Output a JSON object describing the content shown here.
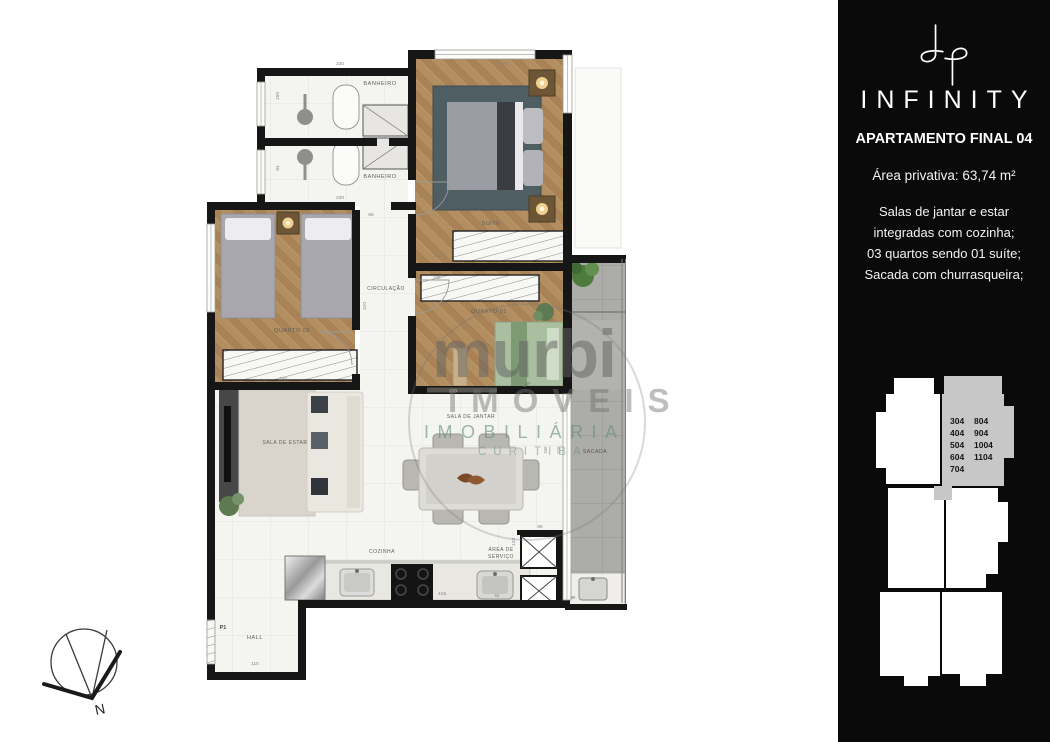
{
  "sidebar": {
    "brand": "INFINITY",
    "apartment_title": "APARTAMENTO FINAL 04",
    "private_area": "Área privativa: 63,74 m²",
    "description_lines": [
      "Salas de jantar e estar",
      "integradas com cozinha;",
      "03 quartos sendo 01 suíte;",
      "Sacada com churrasqueira;"
    ],
    "keyplan_units": {
      "col1": [
        "304",
        "404",
        "504",
        "604",
        "704"
      ],
      "col2": [
        "804",
        "904",
        "1004",
        "1104"
      ]
    }
  },
  "watermark": {
    "brand": "murbi",
    "line2": "IMÓVEIS",
    "line3": "IMOBILIÁRIA",
    "line4": "CURITIBA"
  },
  "plan": {
    "rooms": {
      "banheiro": "BANHEIRO",
      "suite": "SUÍTE",
      "quarto2": "QUARTO 02",
      "quarto1": "QUARTO 01",
      "circulacao": "CIRCULAÇÃO",
      "sacada": "SACADA",
      "sala_estar": "SALA DE ESTAR",
      "sala_jantar": "SALA DE JANTAR",
      "cozinha": "COZINHA",
      "area_servico_l1": "ÁREA DE",
      "area_servico_l2": "SERVIÇO",
      "hall": "HALL"
    },
    "dims": {
      "bath_top_width": "230",
      "bath1_height": "150",
      "bath2_height": "84",
      "bath_bottom_width": "230",
      "suite_width": "240",
      "suite_entry": "90",
      "circ_top": "65",
      "circ_height": "310",
      "suite_closet": "240",
      "q1_closet": "240",
      "q2_width": "245",
      "q1_width": "270",
      "kitchen_run": "415",
      "tank_width": "84",
      "service_depth": "120",
      "shaft_width": "85",
      "churras_width": "90",
      "hall_width": "110",
      "sacada_door_a": "240",
      "sacada_door_b": "510"
    },
    "door_tag": "P1",
    "compass_north": "N"
  },
  "colors": {
    "wall": "#161616",
    "wood_floor": "#b28e60",
    "tile_floor": "#f4f4f1",
    "balcony_concrete": "#acaca8",
    "sidebar_bg": "#0a0a0a",
    "keyplan_highlight": "#c7c7c7",
    "watermark_green": "#648c7a"
  }
}
